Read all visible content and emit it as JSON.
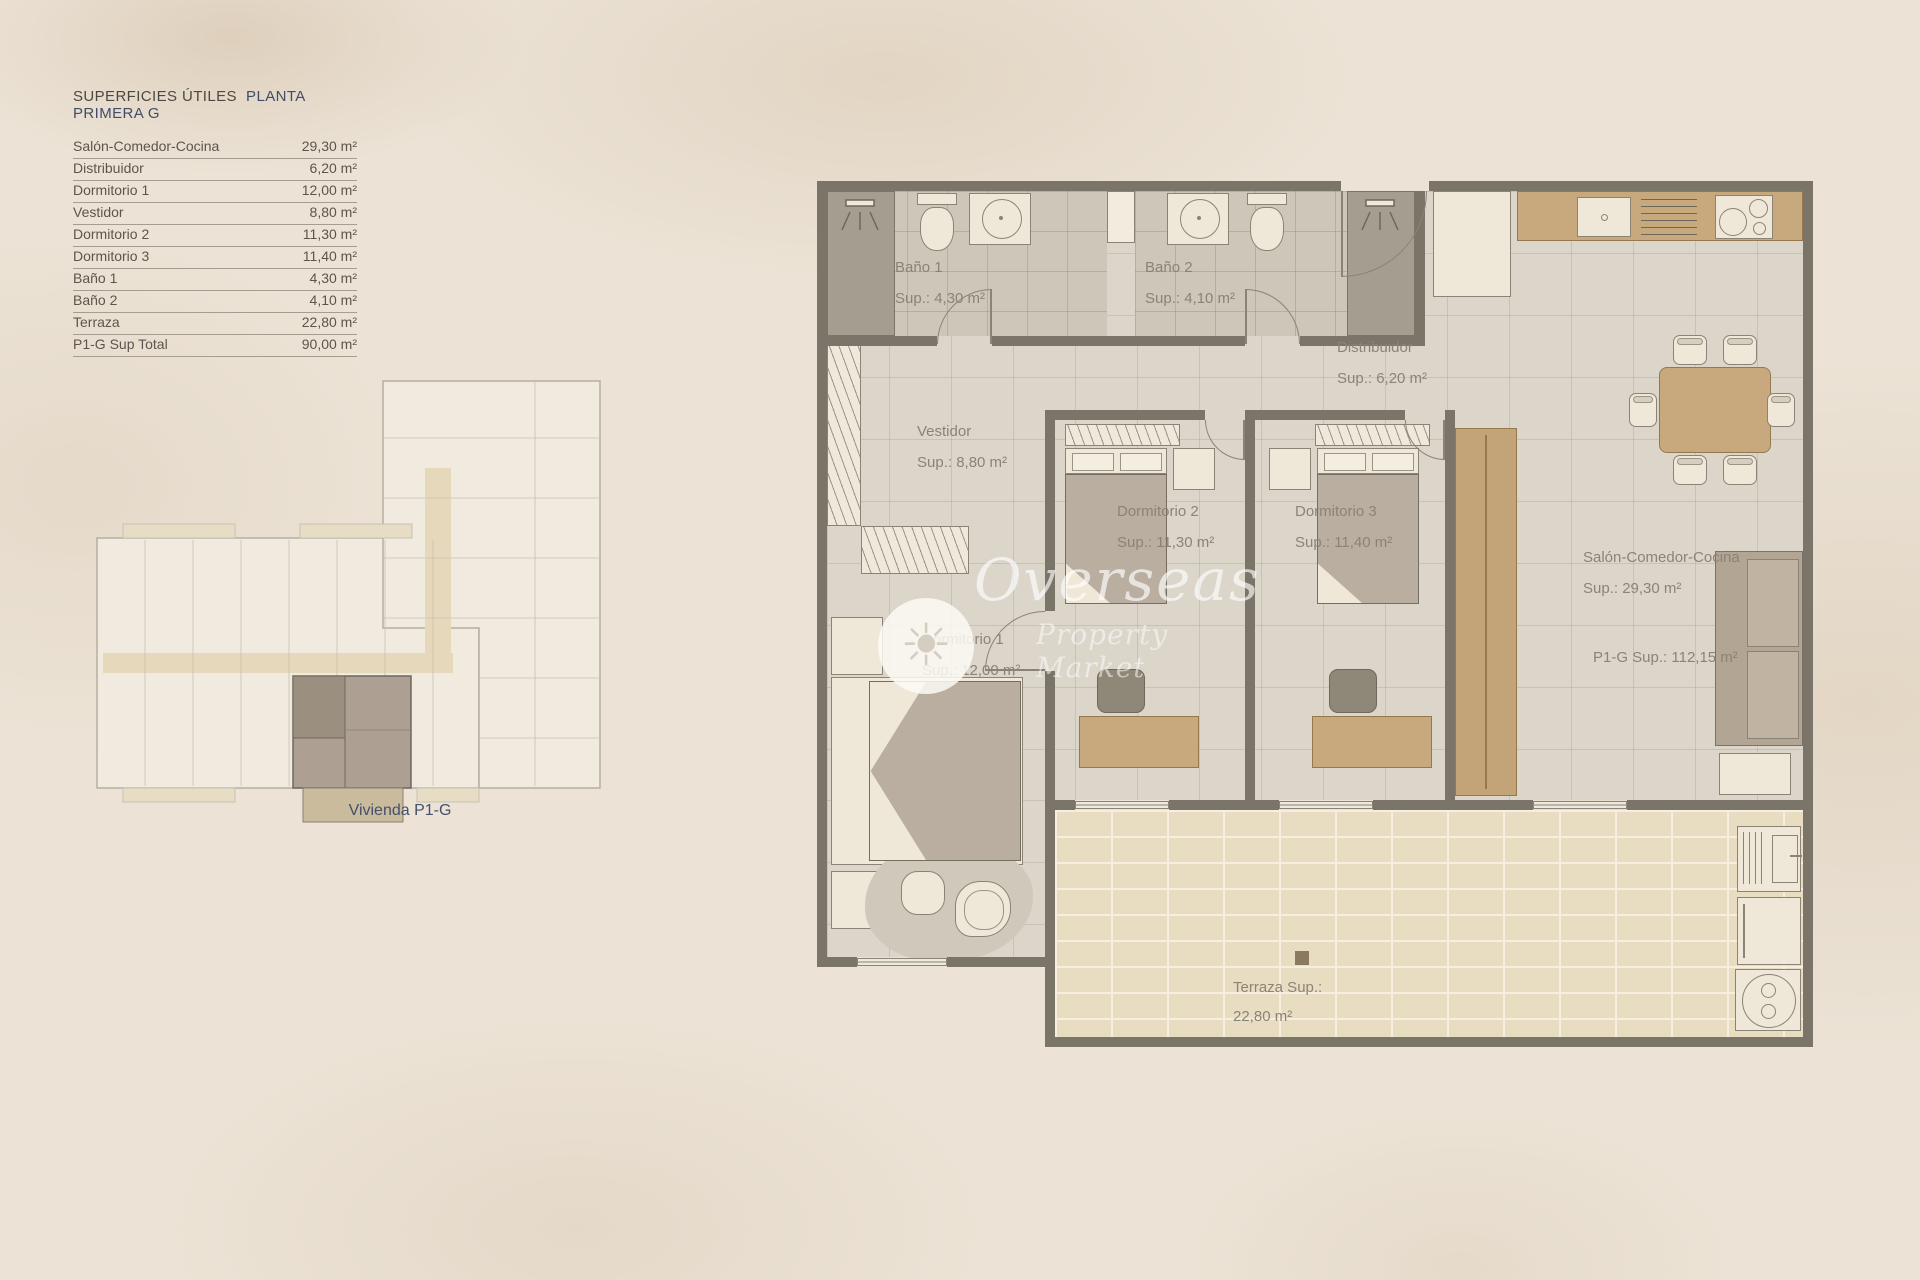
{
  "document": {
    "title_left": "SUPERFICIES ÚTILES",
    "title_right": "PLANTA PRIMERA  G"
  },
  "table": {
    "rows": [
      {
        "label": "Salón-Comedor-Cocina",
        "value": "29,30 m²"
      },
      {
        "label": "Distribuidor",
        "value": "6,20 m²"
      },
      {
        "label": "Dormitorio 1",
        "value": "12,00 m²"
      },
      {
        "label": "Vestidor",
        "value": "8,80 m²"
      },
      {
        "label": "Dormitorio 2",
        "value": "11,30 m²"
      },
      {
        "label": "Dormitorio 3",
        "value": "11,40 m²"
      },
      {
        "label": "Baño 1",
        "value": "4,30 m²"
      },
      {
        "label": "Baño 2",
        "value": "4,10 m²"
      },
      {
        "label": "Terraza",
        "value": "22,80 m²"
      },
      {
        "label": "P1-G Sup Total",
        "value": "90,00 m²"
      }
    ]
  },
  "plan": {
    "rooms": [
      {
        "name": "Baño 1",
        "sup": "Sup.: 4,30  m²"
      },
      {
        "name": "Baño 2",
        "sup": "Sup.: 4,10 m²"
      },
      {
        "name": "Distribuidor",
        "sup": "Sup.: 6,20 m²"
      },
      {
        "name": "Vestidor",
        "sup": "Sup.: 8,80 m²"
      },
      {
        "name": "Dormitorio 2",
        "sup": "Sup.: 11,30 m²"
      },
      {
        "name": "Dormitorio 3",
        "sup": "Sup.: 11,40 m²"
      },
      {
        "name": "Dormitorio 1",
        "sup": "Sup.: 12,00 m²"
      },
      {
        "name": "Salón-Comedor-Cocina",
        "sup": "Sup.: 29,30 m²"
      },
      {
        "name": "Terraza Sup.:",
        "sup": "22,80 m²"
      }
    ],
    "total": "P1-G Sup.: 112,15 m²"
  },
  "overview": {
    "caption": "Vivienda P1-G"
  },
  "watermark": {
    "brand": "Overseas",
    "tagline": "Property Market"
  },
  "colors": {
    "accent_blue": "#3f4d68",
    "wall": "#7b7468",
    "floor_tile": "#dbd5ca",
    "bath_tile": "#cdc6b9",
    "terrace_brick": "#e9ddc1",
    "wood": "#c7a97d",
    "plan_text": "#8a8478",
    "table_text": "#5b564d"
  }
}
